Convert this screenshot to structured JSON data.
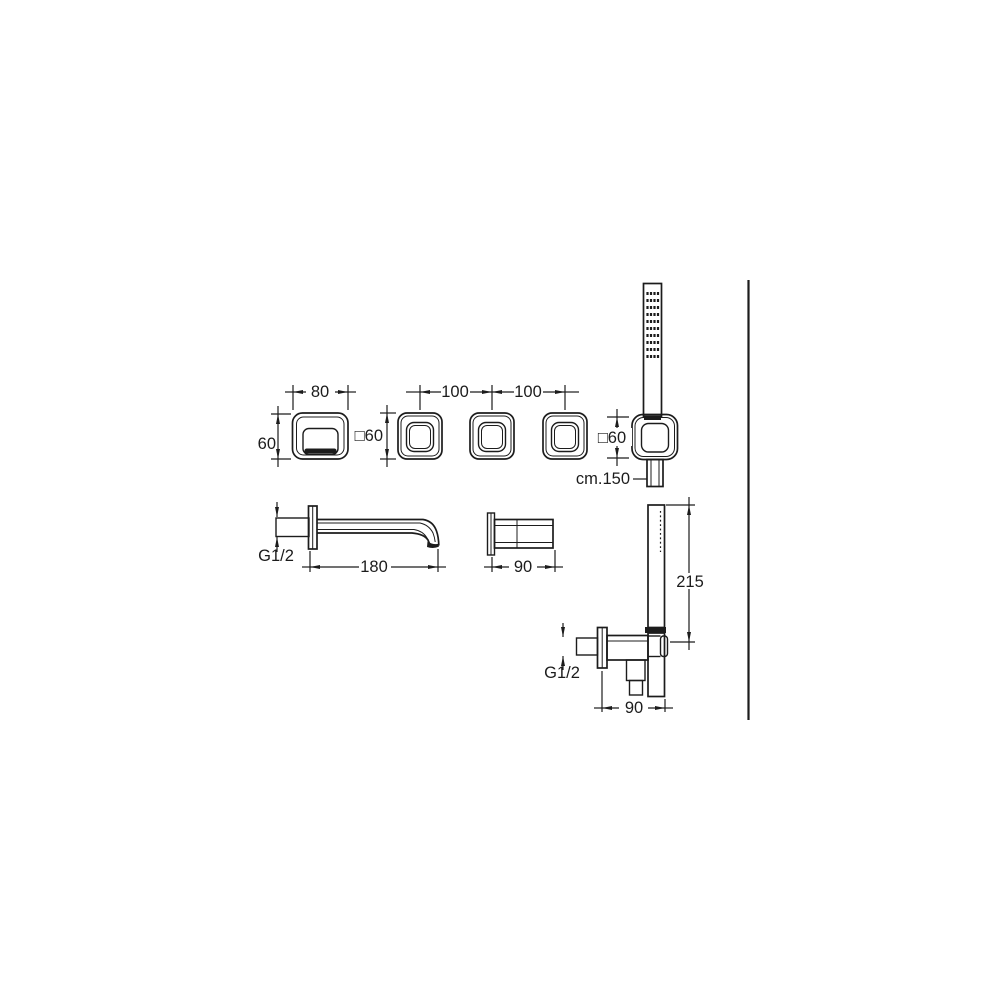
{
  "drawing": {
    "colors": {
      "line": "#1c1c1c",
      "background": "#ffffff"
    },
    "labels": {
      "plate_width": "80",
      "plate_height": "60",
      "handle_spacing_left": "100",
      "handle_spacing_right": "100",
      "handle_square_left": "□60",
      "handle_square_right": "□60",
      "hose_length": "cm.150",
      "spout_thread": "G1/2",
      "spout_length": "180",
      "valve_depth": "90",
      "handshower_height": "215",
      "outlet_thread": "G1/2",
      "outlet_width": "90"
    }
  }
}
